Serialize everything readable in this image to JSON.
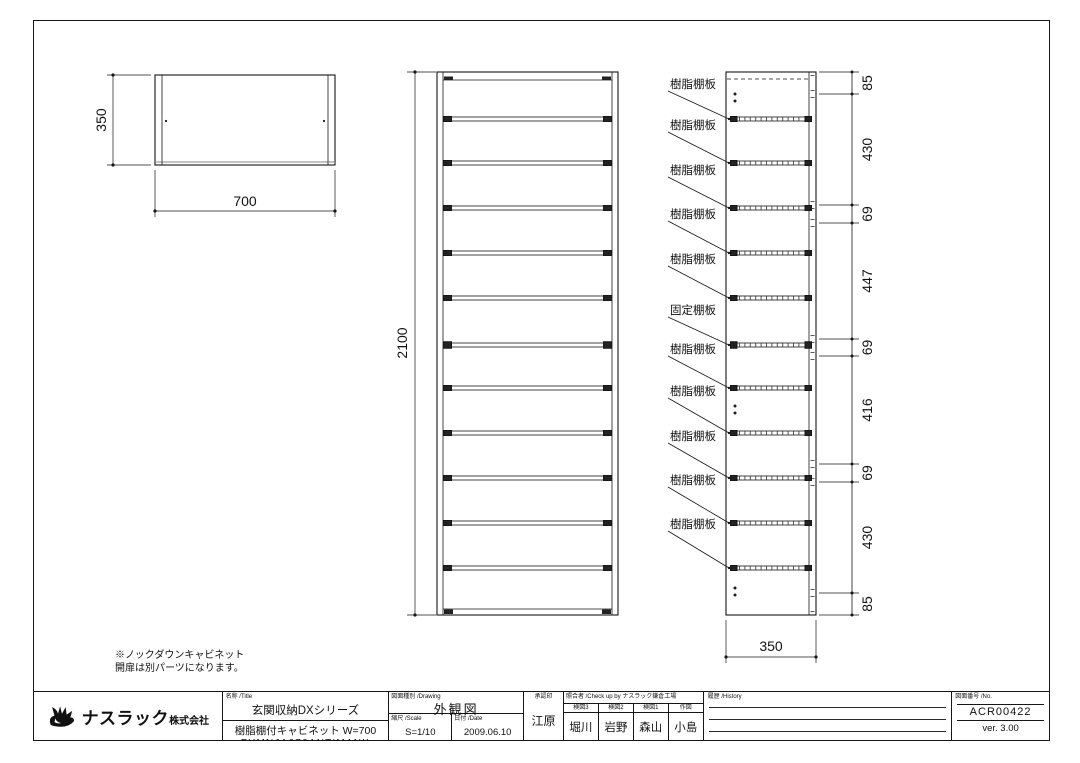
{
  "page": {
    "note_line1": "※ノックダウンキャビネット",
    "note_line2": "開扉は別パーツになります。"
  },
  "views": {
    "top_view": {
      "depth_dim": "350",
      "width_dim": "700"
    },
    "front_view": {
      "height_dim": "2100"
    },
    "side_view": {
      "width_dim": "350",
      "shelf_labels": [
        "樹脂棚板",
        "樹脂棚板",
        "樹脂棚板",
        "樹脂棚板",
        "樹脂棚板",
        "固定棚板",
        "樹脂棚板",
        "樹脂棚板",
        "樹脂棚板",
        "樹脂棚板",
        "樹脂棚板"
      ],
      "segment_dims": [
        "85",
        "430",
        "69",
        "447",
        "69",
        "416",
        "69",
        "430",
        "85"
      ]
    }
  },
  "title_block": {
    "company": {
      "name": "ナスラック",
      "suffix": "株式会社"
    },
    "title_label": "名称 /Title",
    "series": "玄関収納DXシリーズ",
    "product": "樹脂棚付キャビネット W=700",
    "product_code": "FUMNJA070ANTIMANK",
    "drawing_type_label": "図面種別 /Drawing",
    "drawing_type": "外観図",
    "scale_label": "縮尺 /Scale",
    "scale": "S=1/10",
    "date_label": "日付 /Date",
    "date": "2009.06.10",
    "approval_label": "承認印",
    "approver": "江原",
    "check_label": "照合者 /Check up by ナスラック鎌倉工場",
    "checkers": [
      {
        "role": "検図3",
        "name": "堀川"
      },
      {
        "role": "検図2",
        "name": "岩野"
      },
      {
        "role": "検図1",
        "name": "森山"
      },
      {
        "role": "作図",
        "name": "小島"
      }
    ],
    "history_label": "履歴 /History",
    "number_label": "図面番号 /No.",
    "drawing_number": "ACR00422",
    "version": "ver. 3.00"
  }
}
